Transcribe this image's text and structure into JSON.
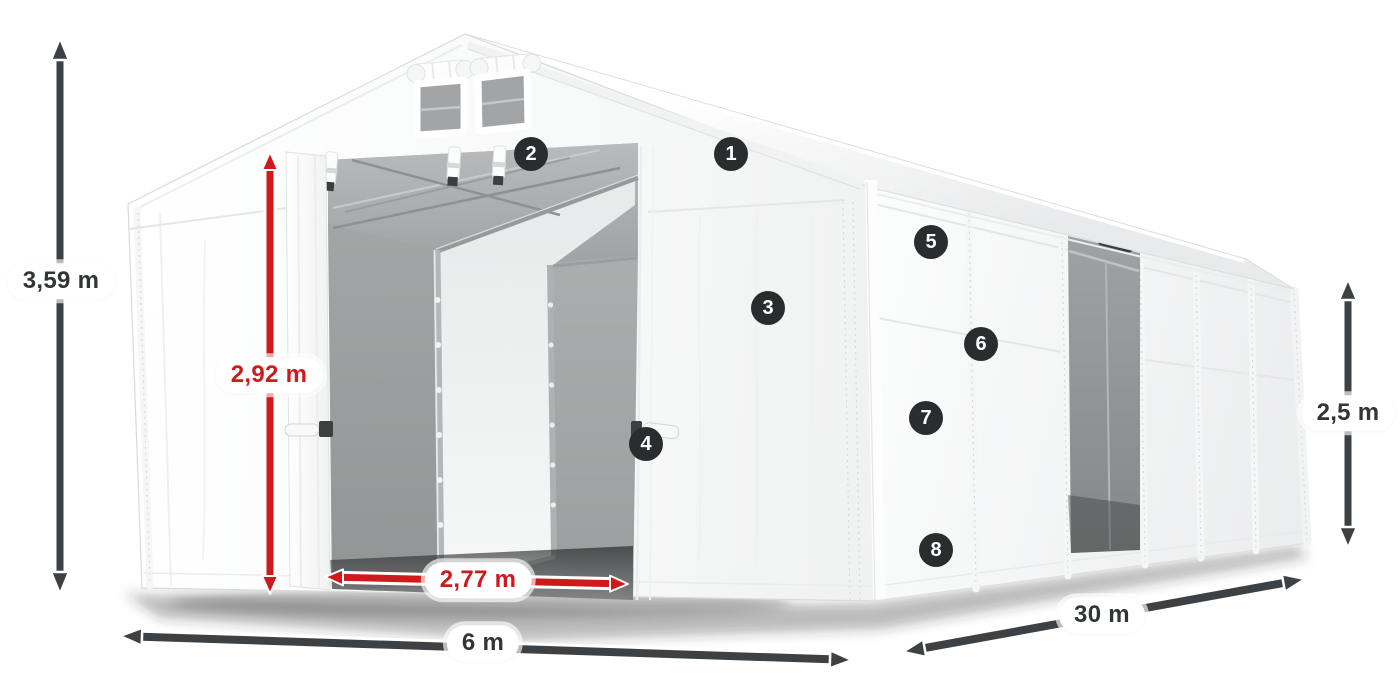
{
  "diagram": {
    "dimensions": {
      "ridge_height": "3,59 m",
      "door_height": "2,92 m",
      "door_width": "2,77 m",
      "tent_width": "6 m",
      "tent_length": "30 m",
      "side_wall_height": "2,5 m"
    },
    "hotspots": [
      "1",
      "2",
      "3",
      "4",
      "5",
      "6",
      "7",
      "8"
    ],
    "colors": {
      "dimension_red": "#ce1a1c",
      "arrow_dark": "#3e4144",
      "badge_bg": "#2a2c2e",
      "badge_text": "#ffffff",
      "pill_bg": "#ffffff",
      "pill_text_dark": "#323537",
      "tent_white": "#ffffff",
      "interior_gray": "#a6a8a9"
    }
  }
}
